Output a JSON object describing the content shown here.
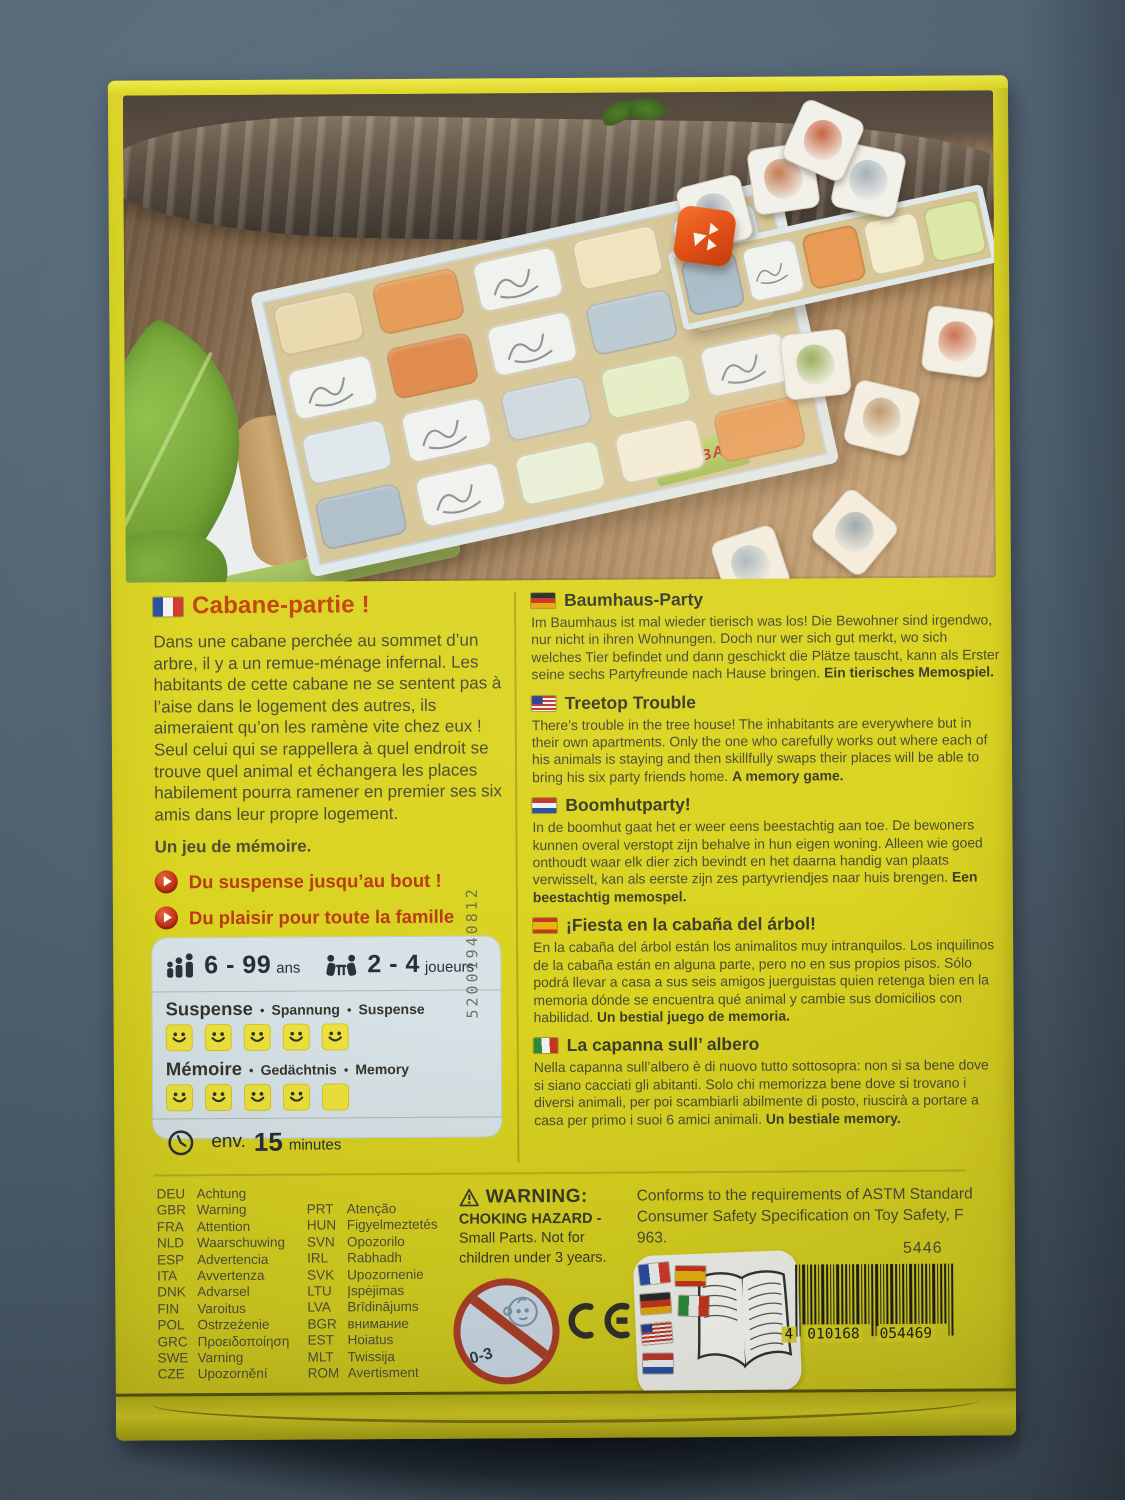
{
  "colors": {
    "background": "#4e6173",
    "box_yellow": "#dbd422",
    "accent_red": "#c2430d",
    "text_olive": "#4c4c34",
    "info_box_bg": "#d6e2e5",
    "smiley_yellow": "#eee23c"
  },
  "photo": {
    "haba_logo": "HABA"
  },
  "left": {
    "title": "Cabane-partie !",
    "body": "Dans une cabane perchée au sommet d’un arbre, il y a un remue-ménage infernal. Les habitants de cette cabane ne se sentent pas à l’aise dans le logement des autres, ils aimeraient qu’on les ramène vite chez eux ! Seul celui qui se rappellera à quel endroit se trouve quel animal et échangera les places habilement pourra ramener en premier ses six amis dans leur propre logement.",
    "memory_note": "Un jeu de mémoire.",
    "bullets": [
      "Du suspense jusqu’au bout !",
      "Du plaisir pour toute la famille"
    ]
  },
  "info_box": {
    "age_value": "6 - 99",
    "age_unit": "ans",
    "players_value": "2 - 4",
    "players_unit": "joueurs",
    "ratings": [
      {
        "labels": [
          "Suspense",
          "Spannung",
          "Suspense"
        ],
        "filled": 5,
        "total": 5
      },
      {
        "labels": [
          "Mémoire",
          "Gedächtnis",
          "Memory"
        ],
        "filled": 4,
        "total": 5
      }
    ],
    "duration_prefix": "env.",
    "duration_value": "15",
    "duration_unit": "minutes"
  },
  "vertical_code": "52001940812",
  "sections": [
    {
      "flag": "de",
      "title": "Baumhaus-Party",
      "body": "Im Baumhaus ist mal wieder tierisch was los! Die Bewohner sind irgendwo, nur nicht in ihren Wohnungen. Doch nur wer sich gut merkt, wo sich welches Tier befindet und dann geschickt die Plätze tauscht, kann als Erster seine sechs Partyfreunde nach Hause bringen. ",
      "bold": "Ein tierisches Memospiel."
    },
    {
      "flag": "us",
      "title": "Treetop Trouble",
      "body": "There’s trouble in the tree house! The inhabitants are everywhere but in their own apartments. Only the one who carefully works out where each of his animals is staying and then skillfully swaps their places will be able to bring his six party friends home. ",
      "bold": "A memory game."
    },
    {
      "flag": "nl",
      "title": "Boomhutparty!",
      "body": "In de boomhut gaat het er weer eens beestachtig aan toe. De bewoners kunnen overal verstopt zijn behalve in hun eigen woning. Alleen wie goed onthoudt waar elk dier zich bevindt en het daarna handig van plaats verwisselt, kan als eerste zijn zes partyvriendjes naar huis brengen. ",
      "bold": "Een beestachtig memospel."
    },
    {
      "flag": "es",
      "title": "¡Fiesta en la cabaña del árbol!",
      "body": "En la cabaña del árbol están los animalitos muy intranquilos. Los inquilinos de la cabaña están en alguna parte, pero no en sus propios pisos. Sólo podrá llevar a casa a sus seis amigos juerguistas quien retenga bien en la memoria dónde se encuentra qué animal y cambie sus domicilios con habilidad. ",
      "bold": "Un bestial juego de memoria."
    },
    {
      "flag": "it",
      "title": "La capanna sull’ albero",
      "body": "Nella capanna sull’albero è di nuovo tutto sottosopra: non si sa bene dove si siano cacciati gli abitanti. Solo chi memorizza bene dove si trovano i diversi animali, per poi scambiarli abilmente di posto, riuscirà a portare a casa per primo i suoi 6 amici animali. ",
      "bold": "Un bestiale memory."
    }
  ],
  "warnings": {
    "col1": [
      {
        "code": "DEU",
        "word": "Achtung"
      },
      {
        "code": "GBR",
        "word": "Warning"
      },
      {
        "code": "FRA",
        "word": "Attention"
      },
      {
        "code": "NLD",
        "word": "Waarschuwing"
      },
      {
        "code": "ESP",
        "word": "Advertencia"
      },
      {
        "code": "ITA",
        "word": "Avvertenza"
      },
      {
        "code": "DNK",
        "word": "Advarsel"
      },
      {
        "code": "FIN",
        "word": "Varoitus"
      },
      {
        "code": "POL",
        "word": "Ostrzeżenie"
      },
      {
        "code": "GRC",
        "word": "Προειδοποίηση"
      },
      {
        "code": "SWE",
        "word": "Varning"
      },
      {
        "code": "CZE",
        "word": "Upozornění"
      }
    ],
    "col2": [
      {
        "code": "PRT",
        "word": "Atenção"
      },
      {
        "code": "HUN",
        "word": "Figyelmeztetés"
      },
      {
        "code": "SVN",
        "word": "Opozorilo"
      },
      {
        "code": "IRL",
        "word": "Rabhadh"
      },
      {
        "code": "SVK",
        "word": "Upozornenie"
      },
      {
        "code": "LTU",
        "word": "Įspėjimas"
      },
      {
        "code": "LVA",
        "word": "Brīdinājums"
      },
      {
        "code": "BGR",
        "word": "внимание"
      },
      {
        "code": "EST",
        "word": "Hoiatus"
      },
      {
        "code": "MLT",
        "word": "Twissija"
      },
      {
        "code": "ROM",
        "word": "Avertisment"
      }
    ]
  },
  "choking": {
    "heading": "WARNING:",
    "line1": "CHOKING HAZARD -",
    "line2": "Small Parts. Not for",
    "line3": "children under 3 years."
  },
  "astm": "Conforms to the requirements of ASTM Standard Consumer Safety Specification on Toy Safety, F 963.",
  "product_number": "5446",
  "barcode": {
    "digits_left": "4",
    "digits_mid": "010168",
    "digits_right": "054469"
  },
  "age_warning_symbol": "0-3",
  "ce": "CE"
}
